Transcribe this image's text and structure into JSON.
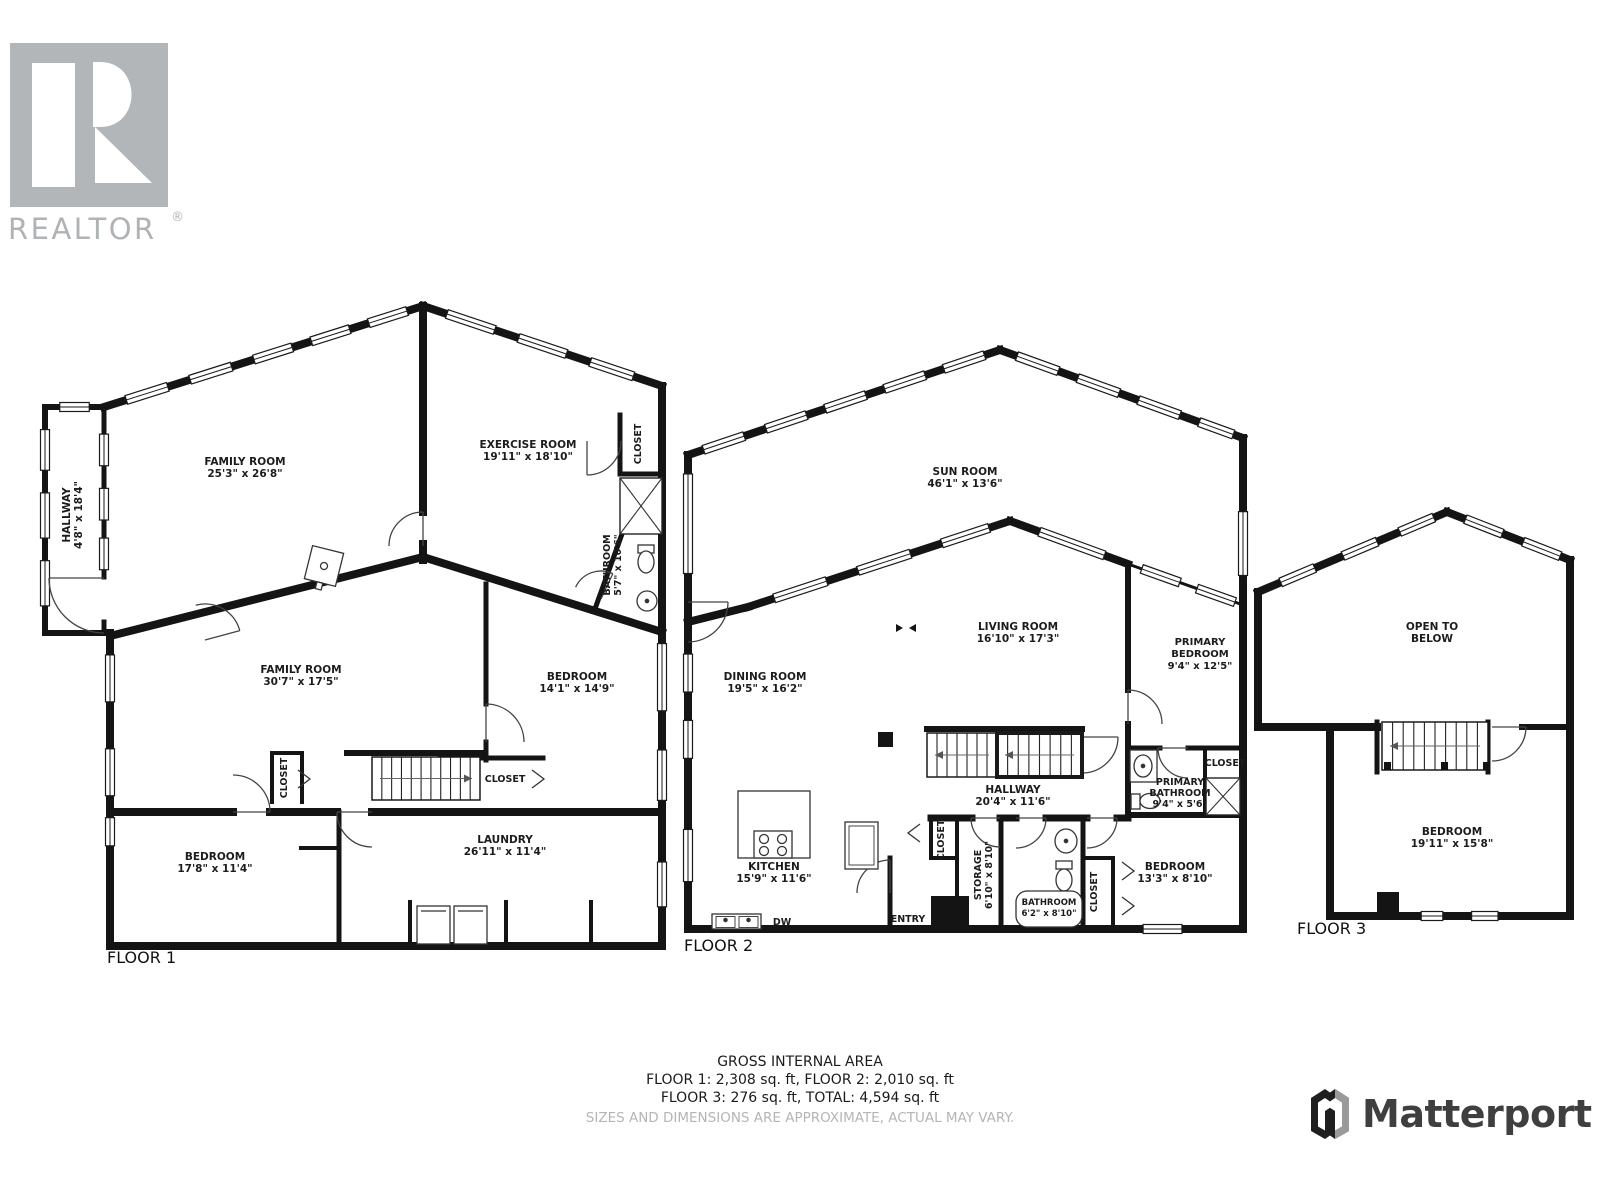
{
  "branding": {
    "realtor": {
      "wordmark": "REALTOR",
      "registered": "®"
    },
    "matterport": {
      "wordmark": "Matterport"
    }
  },
  "floors": [
    {
      "id": "floor-1",
      "label": "FLOOR 1",
      "rooms": [
        {
          "id": "f1-family-room-upper",
          "name_lines": [
            "FAMILY ROOM"
          ],
          "dims": "25'3\" x 26'8\""
        },
        {
          "id": "f1-exercise-room",
          "name_lines": [
            "EXERCISE ROOM"
          ],
          "dims": "19'11\" x 18'10\""
        },
        {
          "id": "f1-hallway",
          "name_lines": [
            "HALLWAY"
          ],
          "dims": "4'8\" x 18'4\""
        },
        {
          "id": "f1-closet-exercise",
          "name_lines": [
            "CLOSET"
          ]
        },
        {
          "id": "f1-bathroom",
          "name_lines": [
            "BATHROOM"
          ],
          "dims": "5'7\" x 10'6\""
        },
        {
          "id": "f1-family-room-lower",
          "name_lines": [
            "FAMILY ROOM"
          ],
          "dims": "30'7\" x 17'5\""
        },
        {
          "id": "f1-bedroom-middle",
          "name_lines": [
            "BEDROOM"
          ],
          "dims": "14'1\" x 14'9\""
        },
        {
          "id": "f1-closet-stairs",
          "name_lines": [
            "CLOSET"
          ]
        },
        {
          "id": "f1-closet-bedroom",
          "name_lines": [
            "CLOSET"
          ]
        },
        {
          "id": "f1-bedroom-lower",
          "name_lines": [
            "BEDROOM"
          ],
          "dims": "17'8\" x 11'4\""
        },
        {
          "id": "f1-laundry",
          "name_lines": [
            "LAUNDRY"
          ],
          "dims": "26'11\" x 11'4\""
        }
      ]
    },
    {
      "id": "floor-2",
      "label": "FLOOR 2",
      "rooms": [
        {
          "id": "f2-sun-room",
          "name_lines": [
            "SUN ROOM"
          ],
          "dims": "46'1\" x 13'6\""
        },
        {
          "id": "f2-dining-room",
          "name_lines": [
            "DINING ROOM"
          ],
          "dims": "19'5\" x 16'2\""
        },
        {
          "id": "f2-living-room",
          "name_lines": [
            "LIVING ROOM"
          ],
          "dims": "16'10\" x 17'3\""
        },
        {
          "id": "f2-primary-bedroom",
          "name_lines": [
            "PRIMARY",
            "BEDROOM"
          ],
          "dims": "9'4\" x 12'5\""
        },
        {
          "id": "f2-hallway",
          "name_lines": [
            "HALLWAY"
          ],
          "dims": "20'4\" x 11'6\""
        },
        {
          "id": "f2-primary-bathroom",
          "name_lines": [
            "PRIMARY",
            "BATHROOM"
          ],
          "dims": "9'4\" x 5'6\""
        },
        {
          "id": "f2-closet-primary",
          "name_lines": [
            "CLOSET"
          ]
        },
        {
          "id": "f2-kitchen",
          "name_lines": [
            "KITCHEN"
          ],
          "dims": "15'9\" x 11'6\""
        },
        {
          "id": "f2-closet-hall",
          "name_lines": [
            "CLOSET"
          ]
        },
        {
          "id": "f2-storage",
          "name_lines": [
            "STORAGE"
          ],
          "dims": "6'10\" x 8'10\""
        },
        {
          "id": "f2-bathroom",
          "name_lines": [
            "BATHROOM"
          ],
          "dims": "6'2\" x 8'10\""
        },
        {
          "id": "f2-closet-bedroom",
          "name_lines": [
            "CLOSET"
          ]
        },
        {
          "id": "f2-bedroom",
          "name_lines": [
            "BEDROOM"
          ],
          "dims": "13'3\" x 8'10\""
        },
        {
          "id": "f2-entry",
          "name_lines": [
            "ENTRY"
          ]
        },
        {
          "id": "f2-dishwasher",
          "name_lines": [
            "DW"
          ]
        }
      ]
    },
    {
      "id": "floor-3",
      "label": "FLOOR 3",
      "rooms": [
        {
          "id": "f3-open-to-below",
          "name_lines": [
            "OPEN TO",
            "BELOW"
          ]
        },
        {
          "id": "f3-bedroom",
          "name_lines": [
            "BEDROOM"
          ],
          "dims": "19'11\" x 15'8\""
        }
      ]
    }
  ],
  "footer": {
    "title": "GROSS INTERNAL AREA",
    "line1": "FLOOR 1: 2,308 sq. ft, FLOOR 2: 2,010 sq. ft",
    "line2": "FLOOR 3: 276 sq. ft, TOTAL: 4,594 sq. ft",
    "disclaimer": "SIZES AND DIMENSIONS ARE APPROXIMATE, ACTUAL MAY VARY."
  }
}
